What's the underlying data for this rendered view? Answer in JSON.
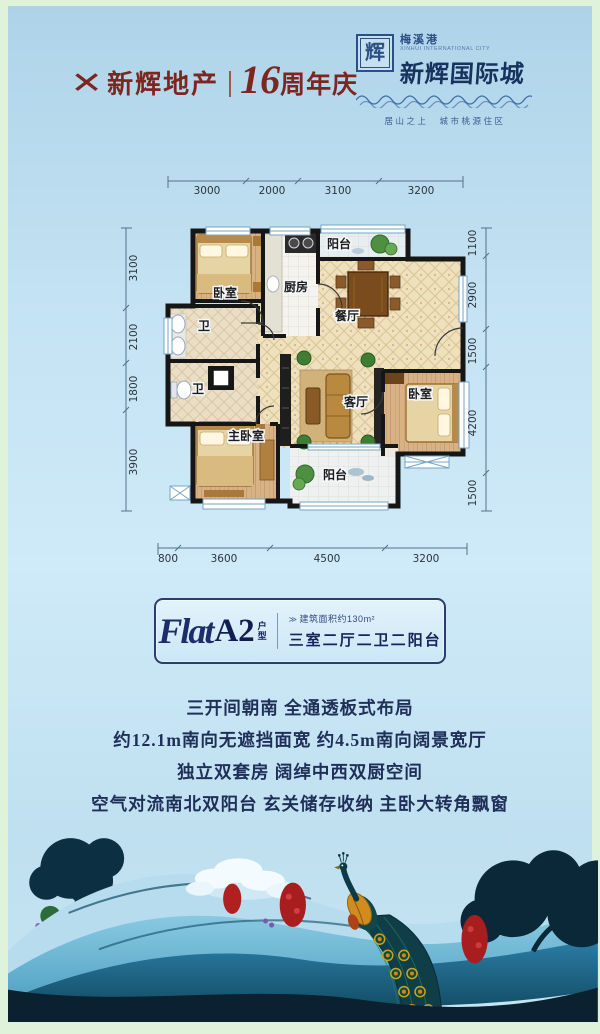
{
  "header": {
    "brand": {
      "mark": "✕",
      "name": "新辉地产",
      "num": "16",
      "suffix": "周年庆"
    },
    "logo": {
      "seal": "辉",
      "sub": "梅溪港",
      "sub_en": "XINHUI INTERNATIONAL CITY",
      "name": "新辉国际城",
      "tagline": "居山之上　城市桃源住区"
    }
  },
  "floor_plan": {
    "dimensions": {
      "top": [
        "3000",
        "2000",
        "3100",
        "3200"
      ],
      "left": [
        "3100",
        "2100",
        "1800",
        "3900"
      ],
      "right": [
        "1100",
        "2900",
        "1500",
        "4200",
        "1500"
      ],
      "bottom": [
        "800",
        "3600",
        "4500",
        "3200"
      ]
    },
    "rooms": {
      "bedroom_top": "卧室",
      "kitchen": "厨房",
      "balcony_top": "阳台",
      "dining": "餐厅",
      "bath_upper": "卫",
      "bath_lower": "卫",
      "master_bedroom": "主卧室",
      "living": "客厅",
      "bedroom_right": "卧室",
      "balcony_bottom": "阳台"
    }
  },
  "unit_card": {
    "flat": "Flat",
    "code": "A2",
    "type": "户型",
    "area_prefix": "≫",
    "area": "建筑面积约130m²",
    "layout": "三室二厅二卫二阳台"
  },
  "features": [
    "三开间朝南 全通透板式布局",
    "约12.1m南向无遮挡面宽 约4.5m南向阔景宽厅",
    "独立双套房 阔绰中西双厨空间",
    "空气对流南北双阳台 玄关储存收纳 主卧大转角飘窗"
  ],
  "colors": {
    "brand_red": "#7d2620",
    "logo_navy": "#1c3a70",
    "sky": "#c3e2f3",
    "frame_green": "#dff2da",
    "wall": "#161616",
    "wood_floor": "#d8b184",
    "tile_floor": "#efe1bd"
  }
}
